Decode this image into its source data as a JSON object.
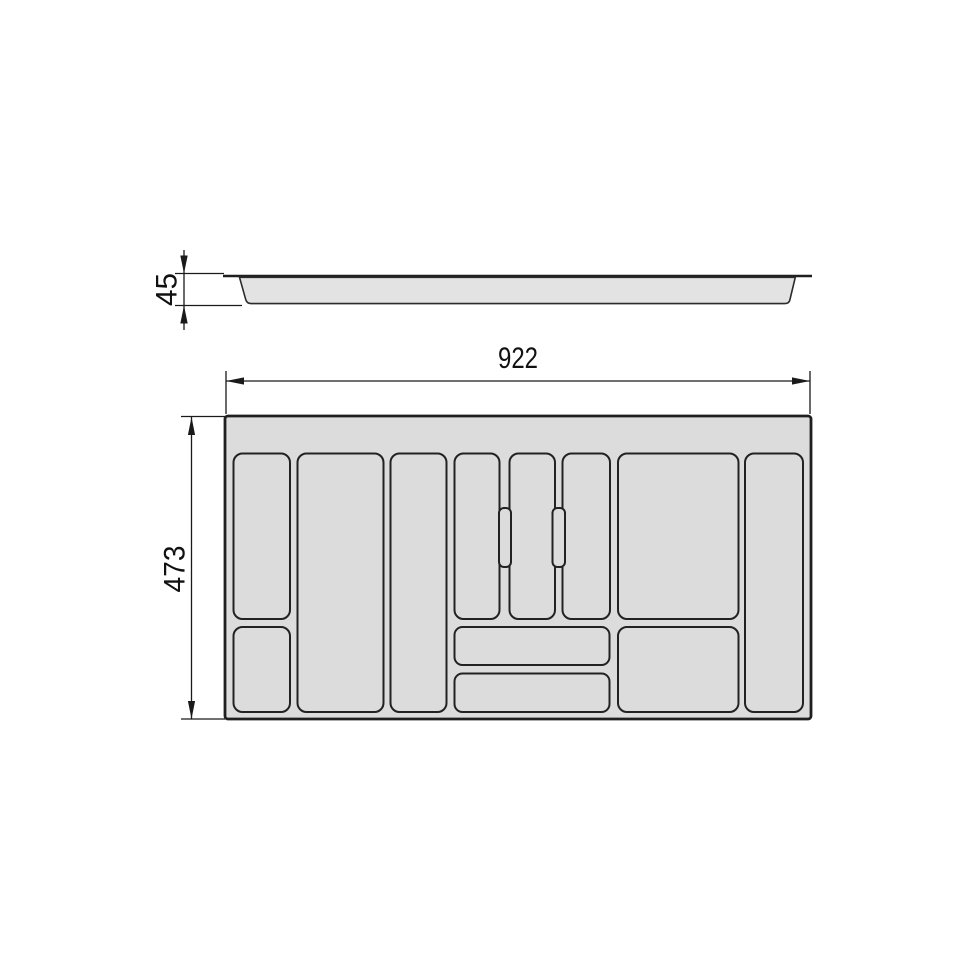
{
  "dimensions": {
    "width": "922",
    "height": "473",
    "depth": "45"
  },
  "colors": {
    "background": "#ffffff",
    "tray_fill": "#dcdcdc",
    "side_body_fill": "#e3e3e3",
    "outline": "#1f1f1f",
    "dimension_lines": "#1a1a1a",
    "text": "#111111"
  }
}
